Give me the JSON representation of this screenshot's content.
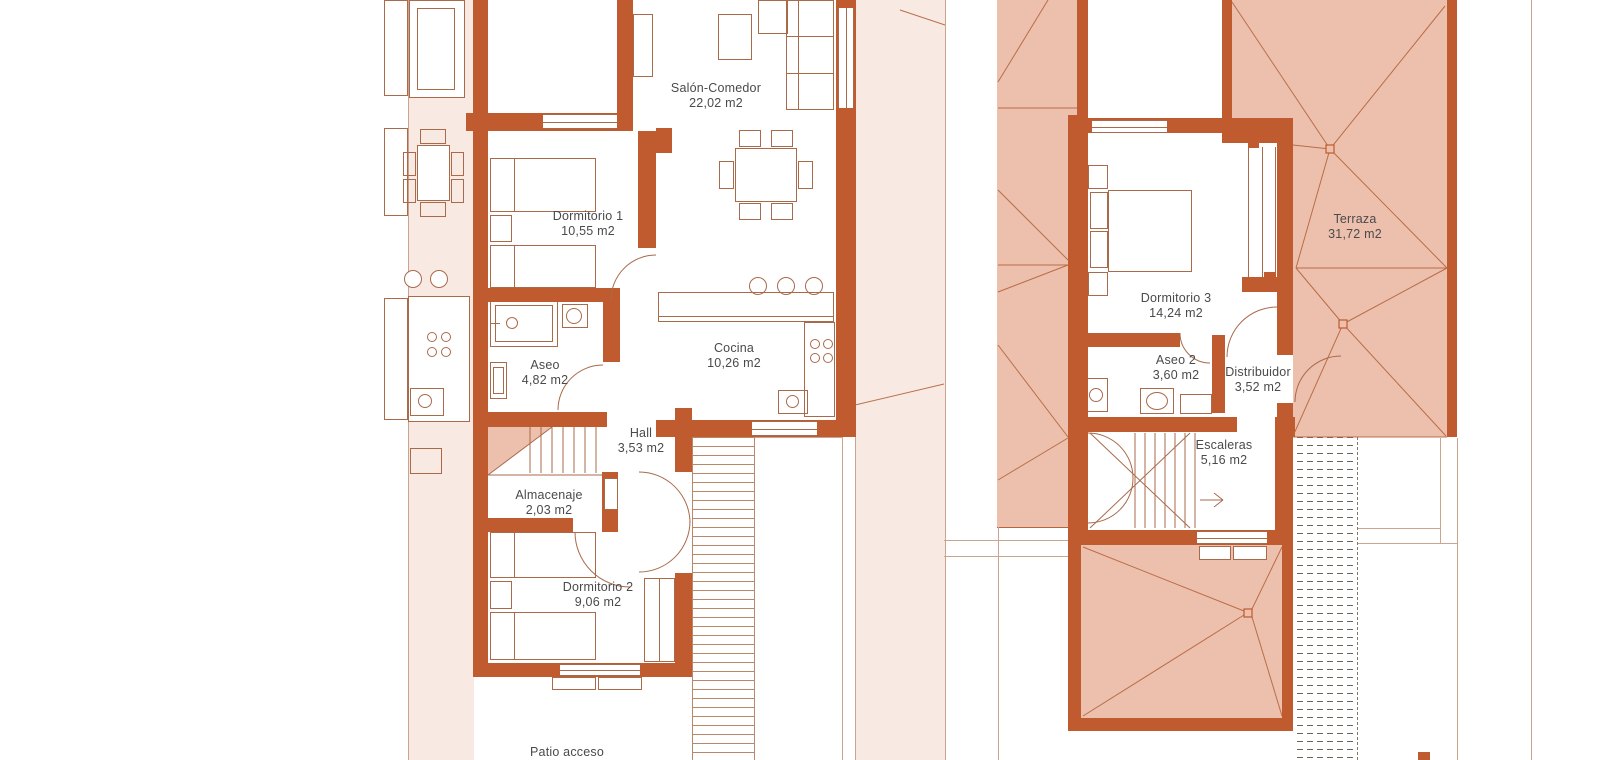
{
  "document": {
    "kind": "architectural floor plan",
    "language": "Spanish"
  },
  "colors": {
    "wall": "#bf5b2e",
    "roof_fill": "#edc0ae",
    "yard_fill": "#f9e9e3",
    "drawing_line": "#a96a4a",
    "ridge_line": "#b5643c",
    "boundary_line": "#c9a58f",
    "hatch_line": "#6f6257",
    "label_text": "#4a4a4a",
    "background": "#ffffff"
  },
  "plans": [
    {
      "name": "ground-floor",
      "rooms": [
        {
          "name": "Salón-Comedor",
          "area": "22,02 m2"
        },
        {
          "name": "Dormitorio 1",
          "area": "10,55 m2"
        },
        {
          "name": "Aseo",
          "area": "4,82 m2"
        },
        {
          "name": "Cocina",
          "area": "10,26 m2"
        },
        {
          "name": "Hall",
          "area": "3,53 m2"
        },
        {
          "name": "Almacenaje",
          "area": "2,03 m2"
        },
        {
          "name": "Dormitorio 2",
          "area": "9,06 m2"
        },
        {
          "name": "Patio acceso",
          "area": ""
        }
      ]
    },
    {
      "name": "first-floor",
      "rooms": [
        {
          "name": "Terraza",
          "area": "31,72 m2"
        },
        {
          "name": "Dormitorio 3",
          "area": "14,24 m2"
        },
        {
          "name": "Aseo 2",
          "area": "3,60 m2"
        },
        {
          "name": "Distribuidor",
          "area": "3,52 m2"
        },
        {
          "name": "Escaleras",
          "area": "5,16 m2"
        }
      ]
    }
  ]
}
